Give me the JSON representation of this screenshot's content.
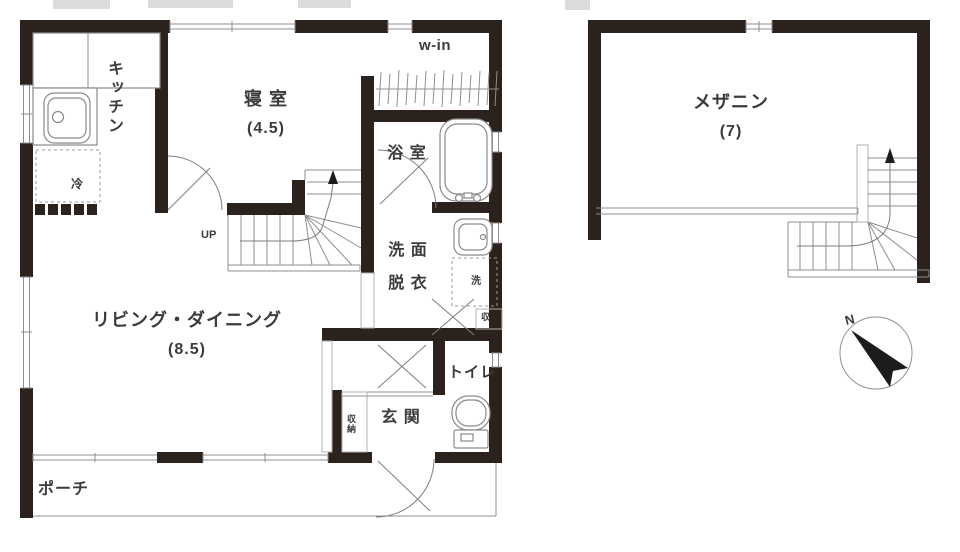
{
  "plan": {
    "floor1": {
      "rooms": {
        "kitchen": {
          "label": "キッチン"
        },
        "bedroom": {
          "label": "寝 室",
          "size": "(4.5)"
        },
        "walk_in_closet": {
          "label": "w-in"
        },
        "bathroom": {
          "label": "浴 室"
        },
        "washroom": {
          "line1": "洗 面",
          "line2": "脱 衣"
        },
        "living_dining": {
          "label": "リビング・ダイニング",
          "size": "(8.5)"
        },
        "toilet": {
          "label": "トイレ"
        },
        "entrance": {
          "label": "玄 関"
        },
        "porch": {
          "label": "ポーチ"
        }
      }
    },
    "floor2": {
      "rooms": {
        "mezzanine": {
          "label": "メザニン",
          "size": "(7)"
        }
      }
    },
    "annotations": {
      "up": "UP",
      "north": "N",
      "fridge": "冷",
      "washer": "洗",
      "storage_abbrev": "収",
      "storage": "収納"
    },
    "colors": {
      "wall": "#2b211d",
      "line": "#8f8f8f",
      "text": "#3b3b3b",
      "compass": "#1c1c1c"
    }
  }
}
